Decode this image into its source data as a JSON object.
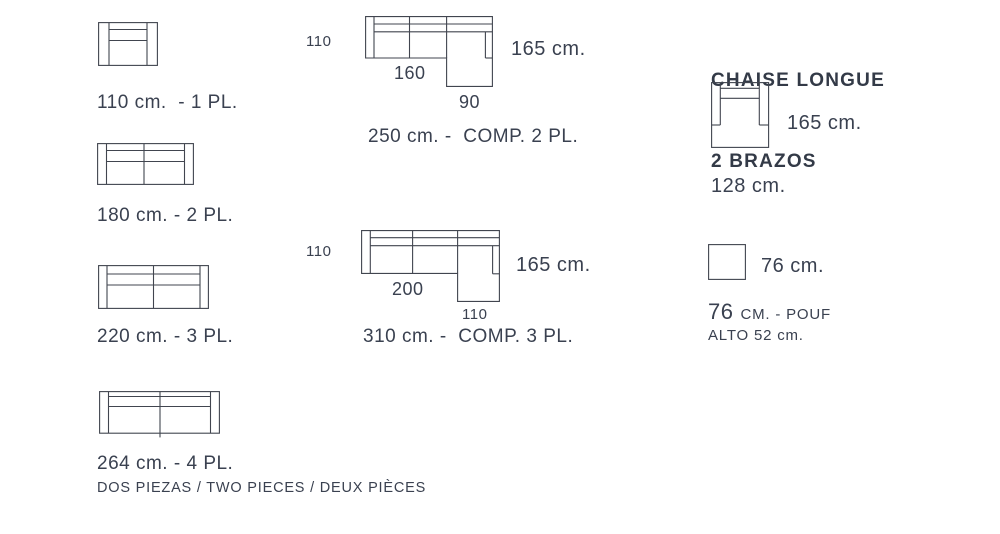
{
  "page": {
    "background": "#ffffff",
    "text_color": "#3a4150",
    "line_color": "#41454f"
  },
  "sofas": [
    {
      "id": "1pl",
      "caption": "110 cm.  - 1 PL."
    },
    {
      "id": "2pl",
      "caption": "180 cm. - 2 PL."
    },
    {
      "id": "3pl",
      "caption": "220 cm. - 3 PL."
    },
    {
      "id": "4pl",
      "caption": "264 cm. - 4 PL.",
      "subcaption": "DOS PIEZAS / TWO PIECES / DEUX PIÈCES"
    }
  ],
  "chaise_comps": [
    {
      "id": "comp2",
      "depth": "110",
      "seat_width": "160",
      "chaise_width": "90",
      "total_depth": "165 cm.",
      "caption": "250 cm. -  COMP. 2 PL."
    },
    {
      "id": "comp3",
      "depth": "110",
      "seat_width": "200",
      "chaise_width": "110",
      "total_depth": "165 cm.",
      "caption": "310 cm. -  COMP. 3 PL."
    }
  ],
  "chaise_longue_2_brazos": {
    "heading_line1": "CHAISE LONGUE",
    "heading_line2": "2 BRAZOS",
    "depth": "165 cm.",
    "width": "128 cm."
  },
  "pouf": {
    "size": "76 cm.",
    "caption_number": "76",
    "caption_text": "CM. - POUF",
    "height": "ALTO 52 cm."
  }
}
